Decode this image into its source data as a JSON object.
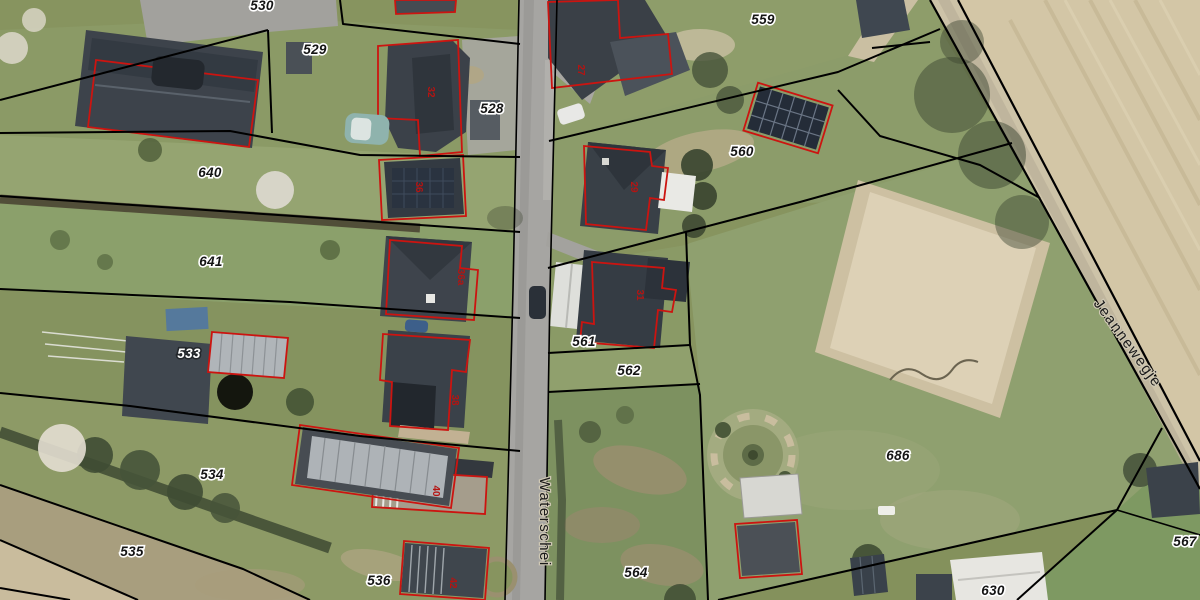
{
  "map": {
    "type": "aerial-cadastral-view",
    "streets": [
      {
        "name": "Waterschei"
      },
      {
        "name": "Jeannewegje"
      }
    ],
    "parcels": [
      {
        "id": "530"
      },
      {
        "id": "529"
      },
      {
        "id": "528"
      },
      {
        "id": "640"
      },
      {
        "id": "641"
      },
      {
        "id": "533"
      },
      {
        "id": "534"
      },
      {
        "id": "535"
      },
      {
        "id": "536"
      },
      {
        "id": "559"
      },
      {
        "id": "560"
      },
      {
        "id": "561"
      },
      {
        "id": "562"
      },
      {
        "id": "564"
      },
      {
        "id": "686"
      },
      {
        "id": "567"
      },
      {
        "id": "630"
      }
    ],
    "house_numbers": [
      {
        "number": "27"
      },
      {
        "number": "29"
      },
      {
        "number": "31"
      },
      {
        "number": "32"
      },
      {
        "number": "36"
      },
      {
        "number": "36a"
      },
      {
        "number": "38"
      },
      {
        "number": "40"
      },
      {
        "number": "42"
      }
    ],
    "colors": {
      "parcel_boundary": "#000000",
      "building_outline": "#cc1410",
      "parcel_label_text": "#141414",
      "parcel_label_halo": "#ffffff",
      "house_number_text": "#b41412",
      "street_label_text": "#1b1b1b",
      "grass": "#87945f",
      "plowed_field": "#d3c6a6",
      "asphalt_road": "#a6a5a2",
      "sand_arena": "#d6c9ad",
      "roof_dark": "#3a4047"
    }
  }
}
